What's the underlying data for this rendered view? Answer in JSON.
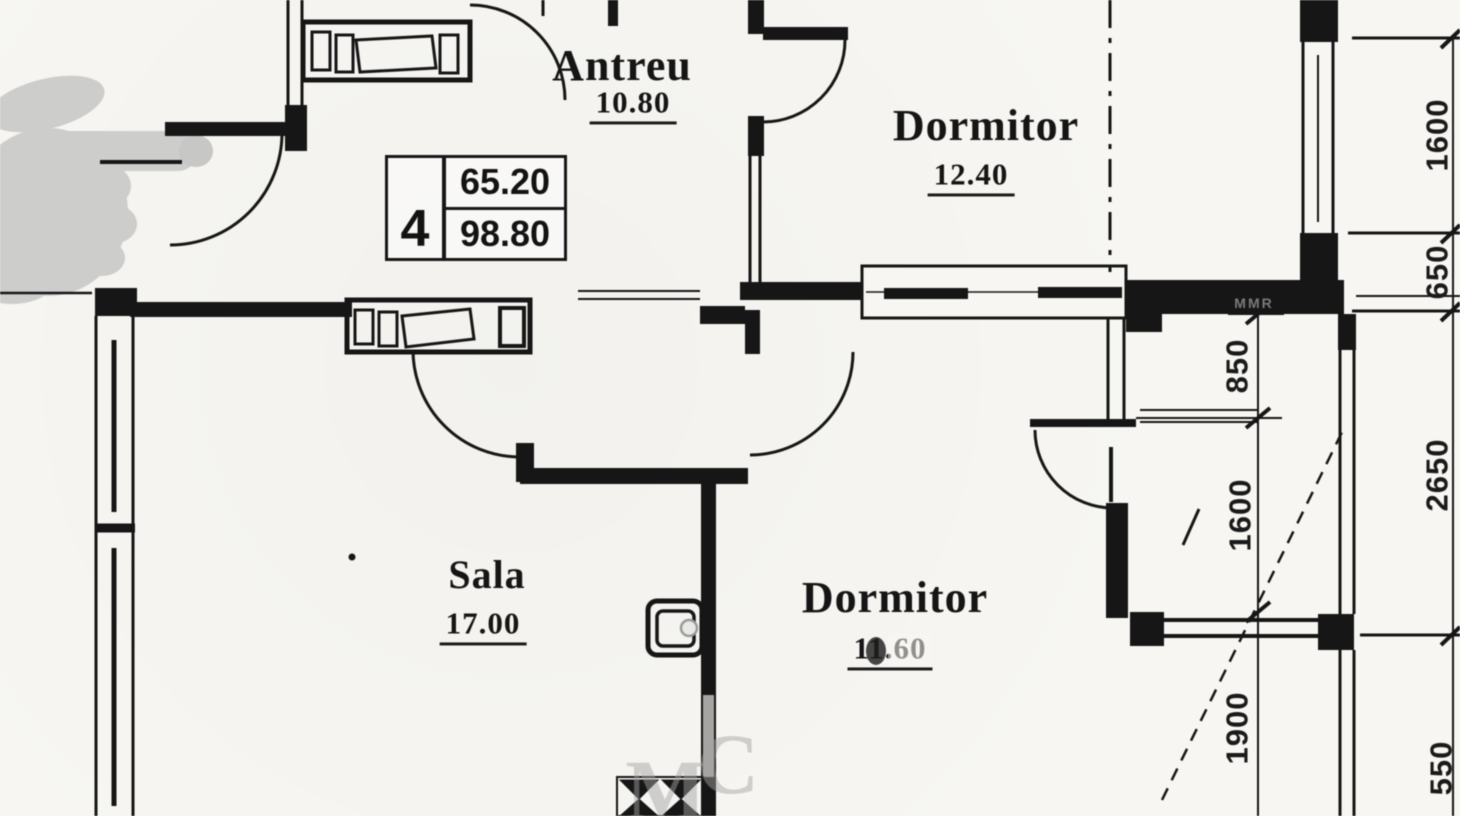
{
  "plan": {
    "rooms": {
      "antreu": {
        "name": "Antreu",
        "area": "10.80"
      },
      "dormitor1": {
        "name": "Dormitor",
        "area": "12.40"
      },
      "sala": {
        "name": "Sala",
        "area": "17.00"
      },
      "dormitor2": {
        "name": "Dormitor",
        "area": "11.60"
      }
    },
    "info_box": {
      "number": "4",
      "area_useful": "65.20",
      "area_built": "98.80"
    },
    "dimensions": {
      "right_outer": {
        "d1": "1600",
        "d2": "650",
        "d3": "2650",
        "d4": "550"
      },
      "right_inner": {
        "d1": "850",
        "d2": "1600",
        "d3": "1900"
      }
    },
    "watermarks": {
      "letter_m": "M",
      "letter_c": "C",
      "wall_text": "MMR"
    },
    "colors": {
      "ink": "#161616",
      "paper": "#f7f6f2",
      "watermark_gray": "#c9c9c9"
    }
  }
}
